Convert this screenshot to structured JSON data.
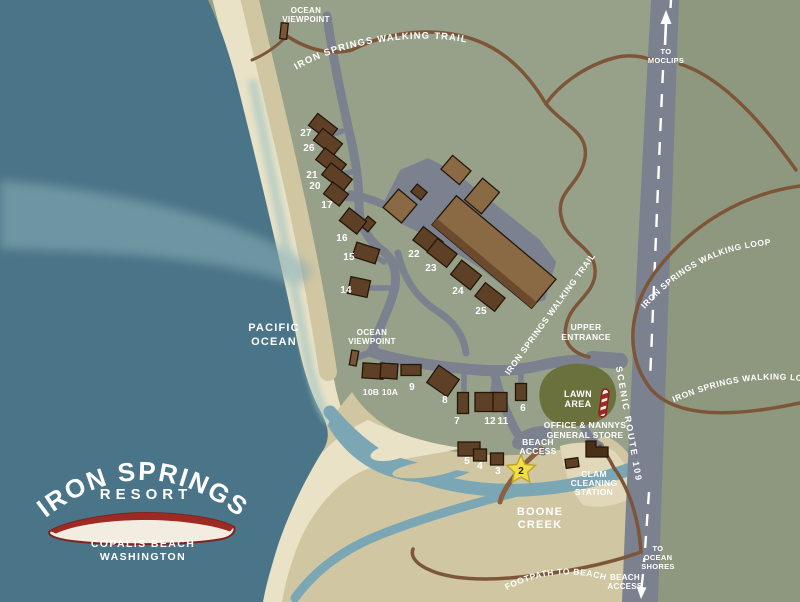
{
  "colors": {
    "ocean": "#4a7487",
    "wave": "#85abb5",
    "sand_light": "#e9e2c6",
    "sand_tan": "#d0c7a2",
    "land": "#97a189",
    "land_east": "#8e987e",
    "road": "#7b818f",
    "trail": "#7d563a",
    "creek": "#7ba7b5",
    "building": "#5e4026",
    "building_light": "#8a6a45",
    "lawn": "#6a713d",
    "star": "#f2df45",
    "logo_red": "#9e2b23"
  },
  "logo": {
    "name": "IRON SPRINGS",
    "subtitle": "RESORT",
    "city": "COPALIS BEACH",
    "state": "WASHINGTON"
  },
  "ocean": {
    "line1": "PACIFIC",
    "line2": "OCEAN"
  },
  "roads": {
    "to_moclips": [
      "TO",
      "MOCLIPS"
    ],
    "to_ocean_shores": [
      "TO",
      "OCEAN",
      "SHORES"
    ],
    "scenic_route": "SCENIC ROUTE 109",
    "upper_entrance": [
      "UPPER",
      "ENTRANCE"
    ]
  },
  "trails": {
    "walking_trail_top": "IRON SPRINGS WALKING TRAIL",
    "walking_trail_mid": "IRON SPRINGS WALKING TRAIL",
    "walking_loop_upper": "IRON SPRINGS WALKING LOOP",
    "walking_loop_lower": "IRON SPRINGS WALKING LOOP",
    "footpath": "FOOTPATH TO BEACH"
  },
  "places": {
    "ocean_viewpoint_top": [
      "OCEAN",
      "VIEWPOINT"
    ],
    "ocean_viewpoint_mid": [
      "OCEAN",
      "VIEWPOINT"
    ],
    "lawn_area": [
      "LAWN",
      "AREA"
    ],
    "office": [
      "OFFICE & NANNYS",
      "GENERAL STORE"
    ],
    "beach_access_mid": [
      "BEACH",
      "ACCESS"
    ],
    "clam_station": [
      "CLAM",
      "CLEANING",
      "STATION"
    ],
    "boone_creek": [
      "BOONE",
      "CREEK"
    ],
    "beach_access_bottom": [
      "BEACH",
      "ACCESS"
    ]
  },
  "cabins": {
    "numbers": [
      "27",
      "26",
      "21",
      "20",
      "17",
      "16",
      "15",
      "14",
      "22",
      "23",
      "24",
      "25",
      "10B",
      "10A",
      "9",
      "8",
      "7",
      "12",
      "11",
      "6",
      "5",
      "4",
      "3"
    ],
    "star": "2"
  }
}
